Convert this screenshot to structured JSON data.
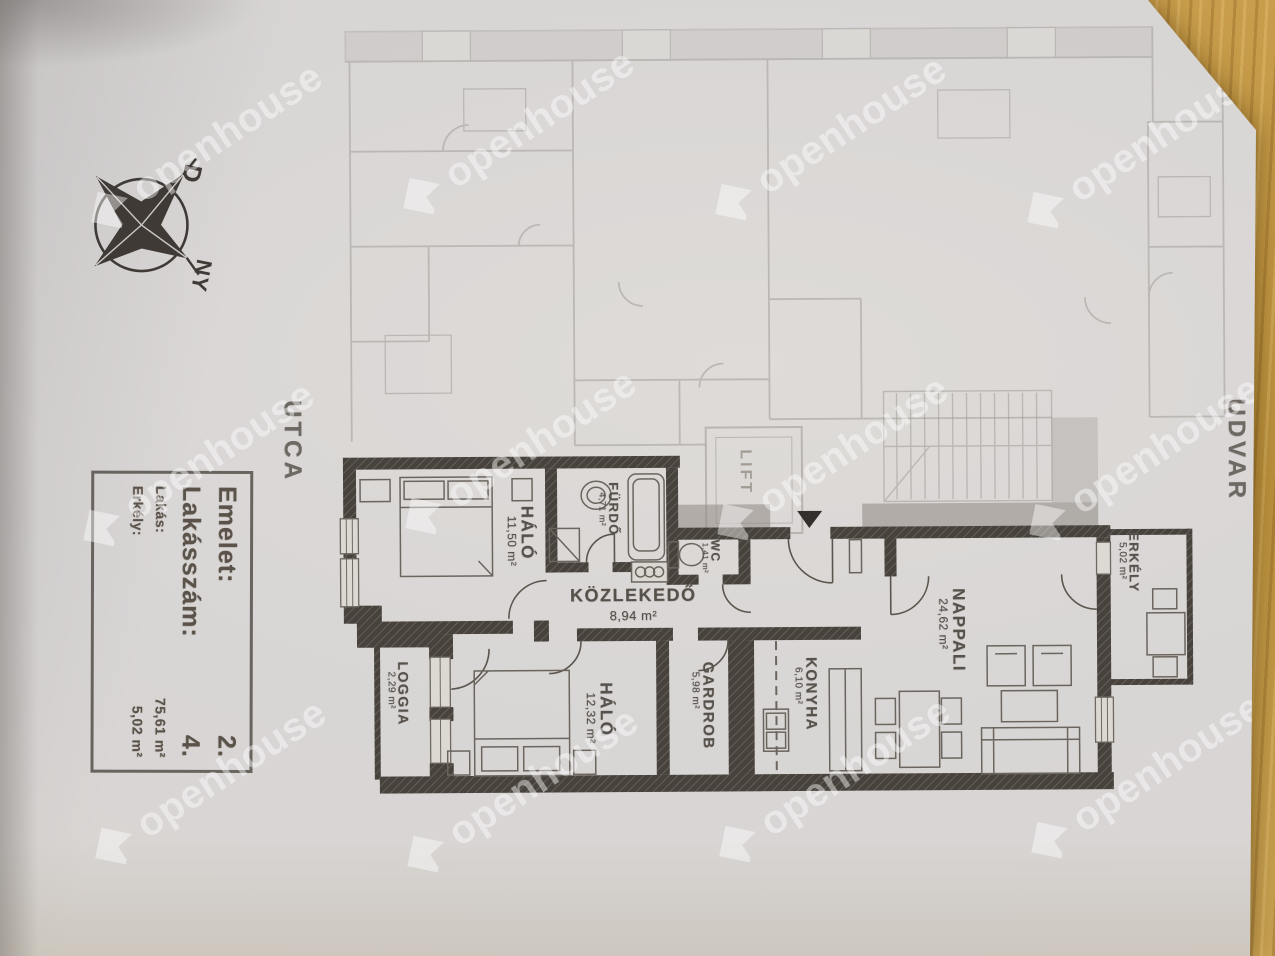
{
  "stamp": {
    "floor_label": "Emelet:",
    "floor_value": "2.",
    "apartment_label": "Lakásszám:",
    "apartment_value": "4.",
    "flat_label": "Lakás:",
    "flat_value": "75,61 m²",
    "balcony_label": "Erkély:",
    "balcony_value": "5,02 m²"
  },
  "compass": {
    "south": "D",
    "west": "NY"
  },
  "surroundings": {
    "street": "UTCA",
    "courtyard": "UDVAR"
  },
  "rooms": {
    "halo1": {
      "name": "HÁLÓ",
      "area": "11,50 m²"
    },
    "furdo": {
      "name": "FÜRDŐ",
      "area": "4,71 m²"
    },
    "wc": {
      "name": "WC",
      "area": "1,41 m²"
    },
    "kozlekedo": {
      "name": "KÖZLEKEDŐ",
      "area": "8,94 m²"
    },
    "nappali": {
      "name": "NAPPALI",
      "area": "24,62 m²"
    },
    "erkely": {
      "name": "ERKÉLY",
      "area": "5,02 m²"
    },
    "loggia": {
      "name": "LOGGIA",
      "area": "2,29 m²"
    },
    "halo2": {
      "name": "HÁLÓ",
      "area": "12,32 m²"
    },
    "gardrob": {
      "name": "GARDROB",
      "area": "5,98 m²"
    },
    "konyha": {
      "name": "KONYHA",
      "area": "6,10 m²"
    },
    "lift": {
      "name": "LIFT"
    }
  },
  "watermark": {
    "text": "openhouse"
  }
}
